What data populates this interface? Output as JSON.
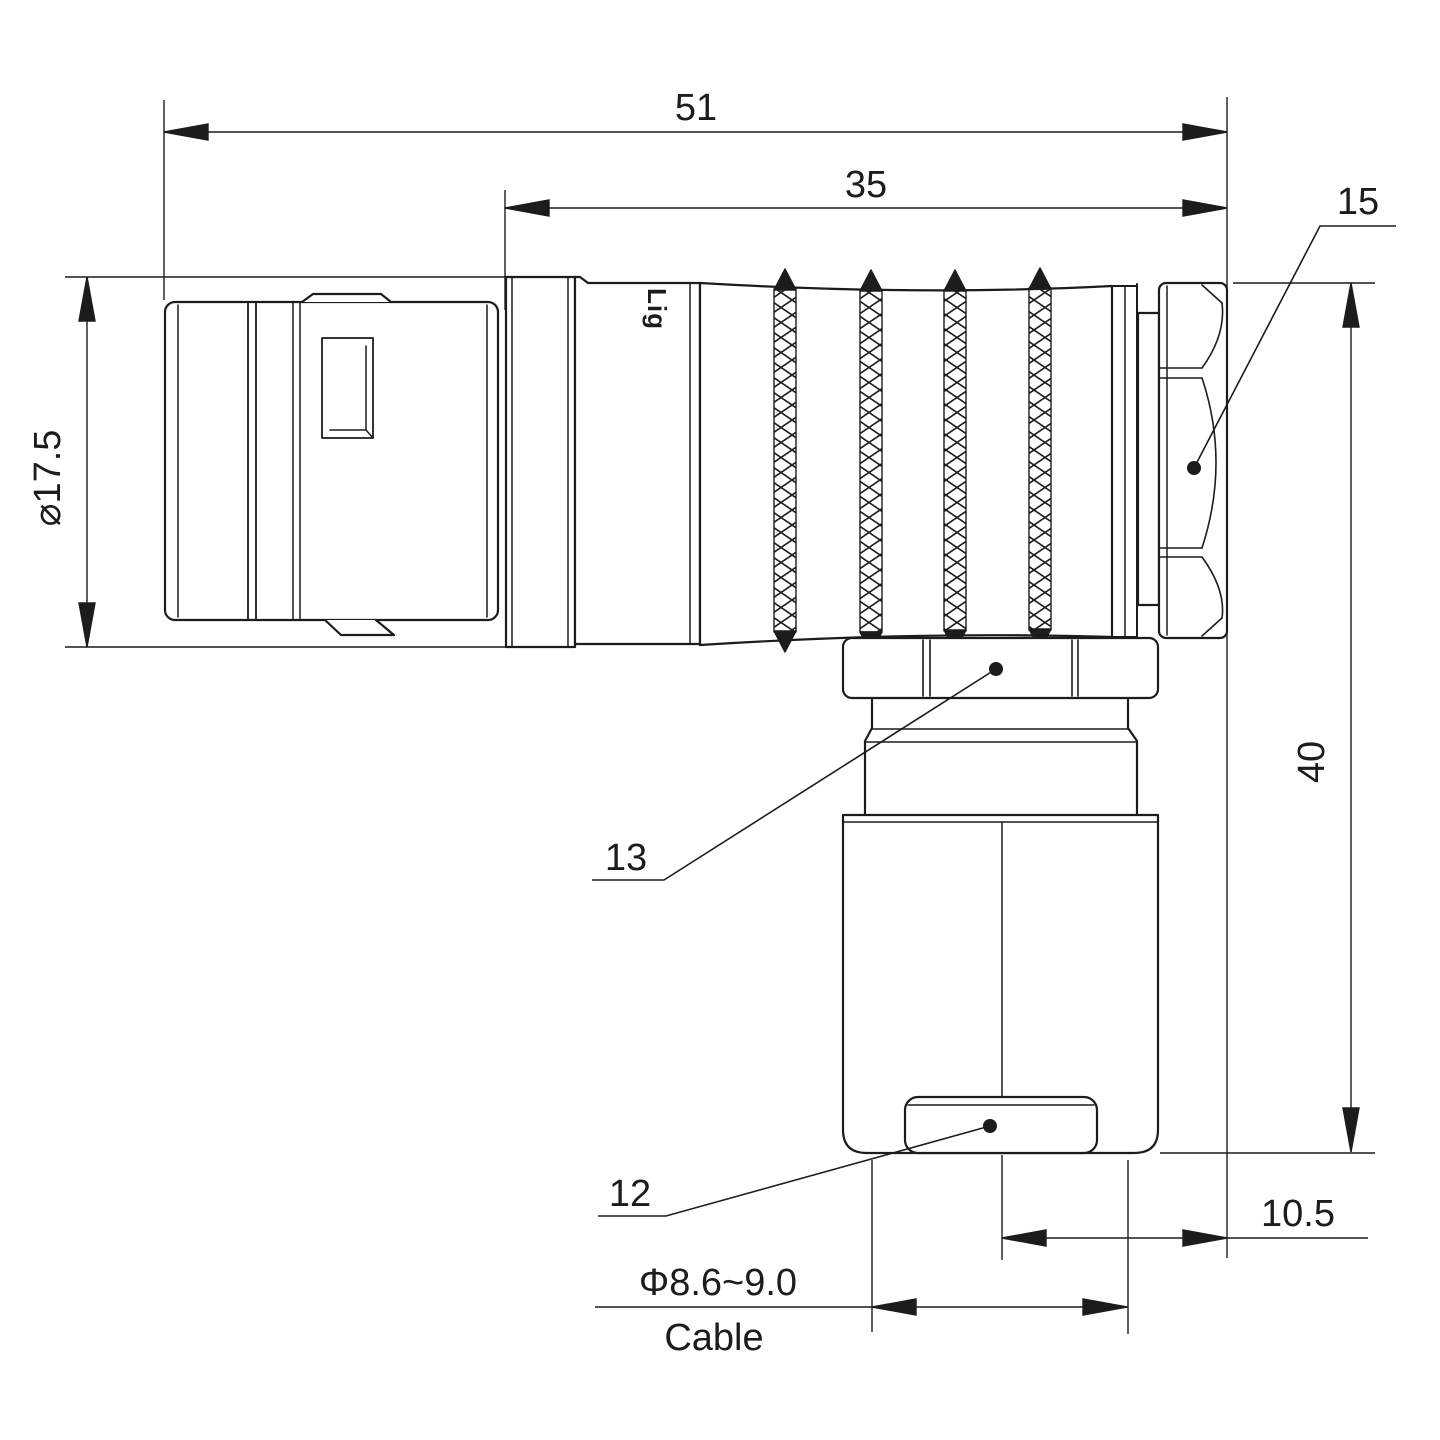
{
  "drawing": {
    "title": "right-angle connector dimension drawing",
    "background": "#ffffff",
    "line_color": "#1c1c1c",
    "watermark": {
      "text": "Lightany",
      "color": "#eec0c0"
    },
    "brand_mark": "Lig",
    "dimensions": {
      "overall_length": "51",
      "barrel_length": "35",
      "front_diameter": "⌀17.5",
      "total_height": "40",
      "axis_offset": "10.5",
      "cable_diameter": "Φ8.6~9.0",
      "cable_word": "Cable"
    },
    "callouts": {
      "end_hex_nut": "15",
      "gland_nut": "13",
      "boot_cap": "12"
    }
  }
}
